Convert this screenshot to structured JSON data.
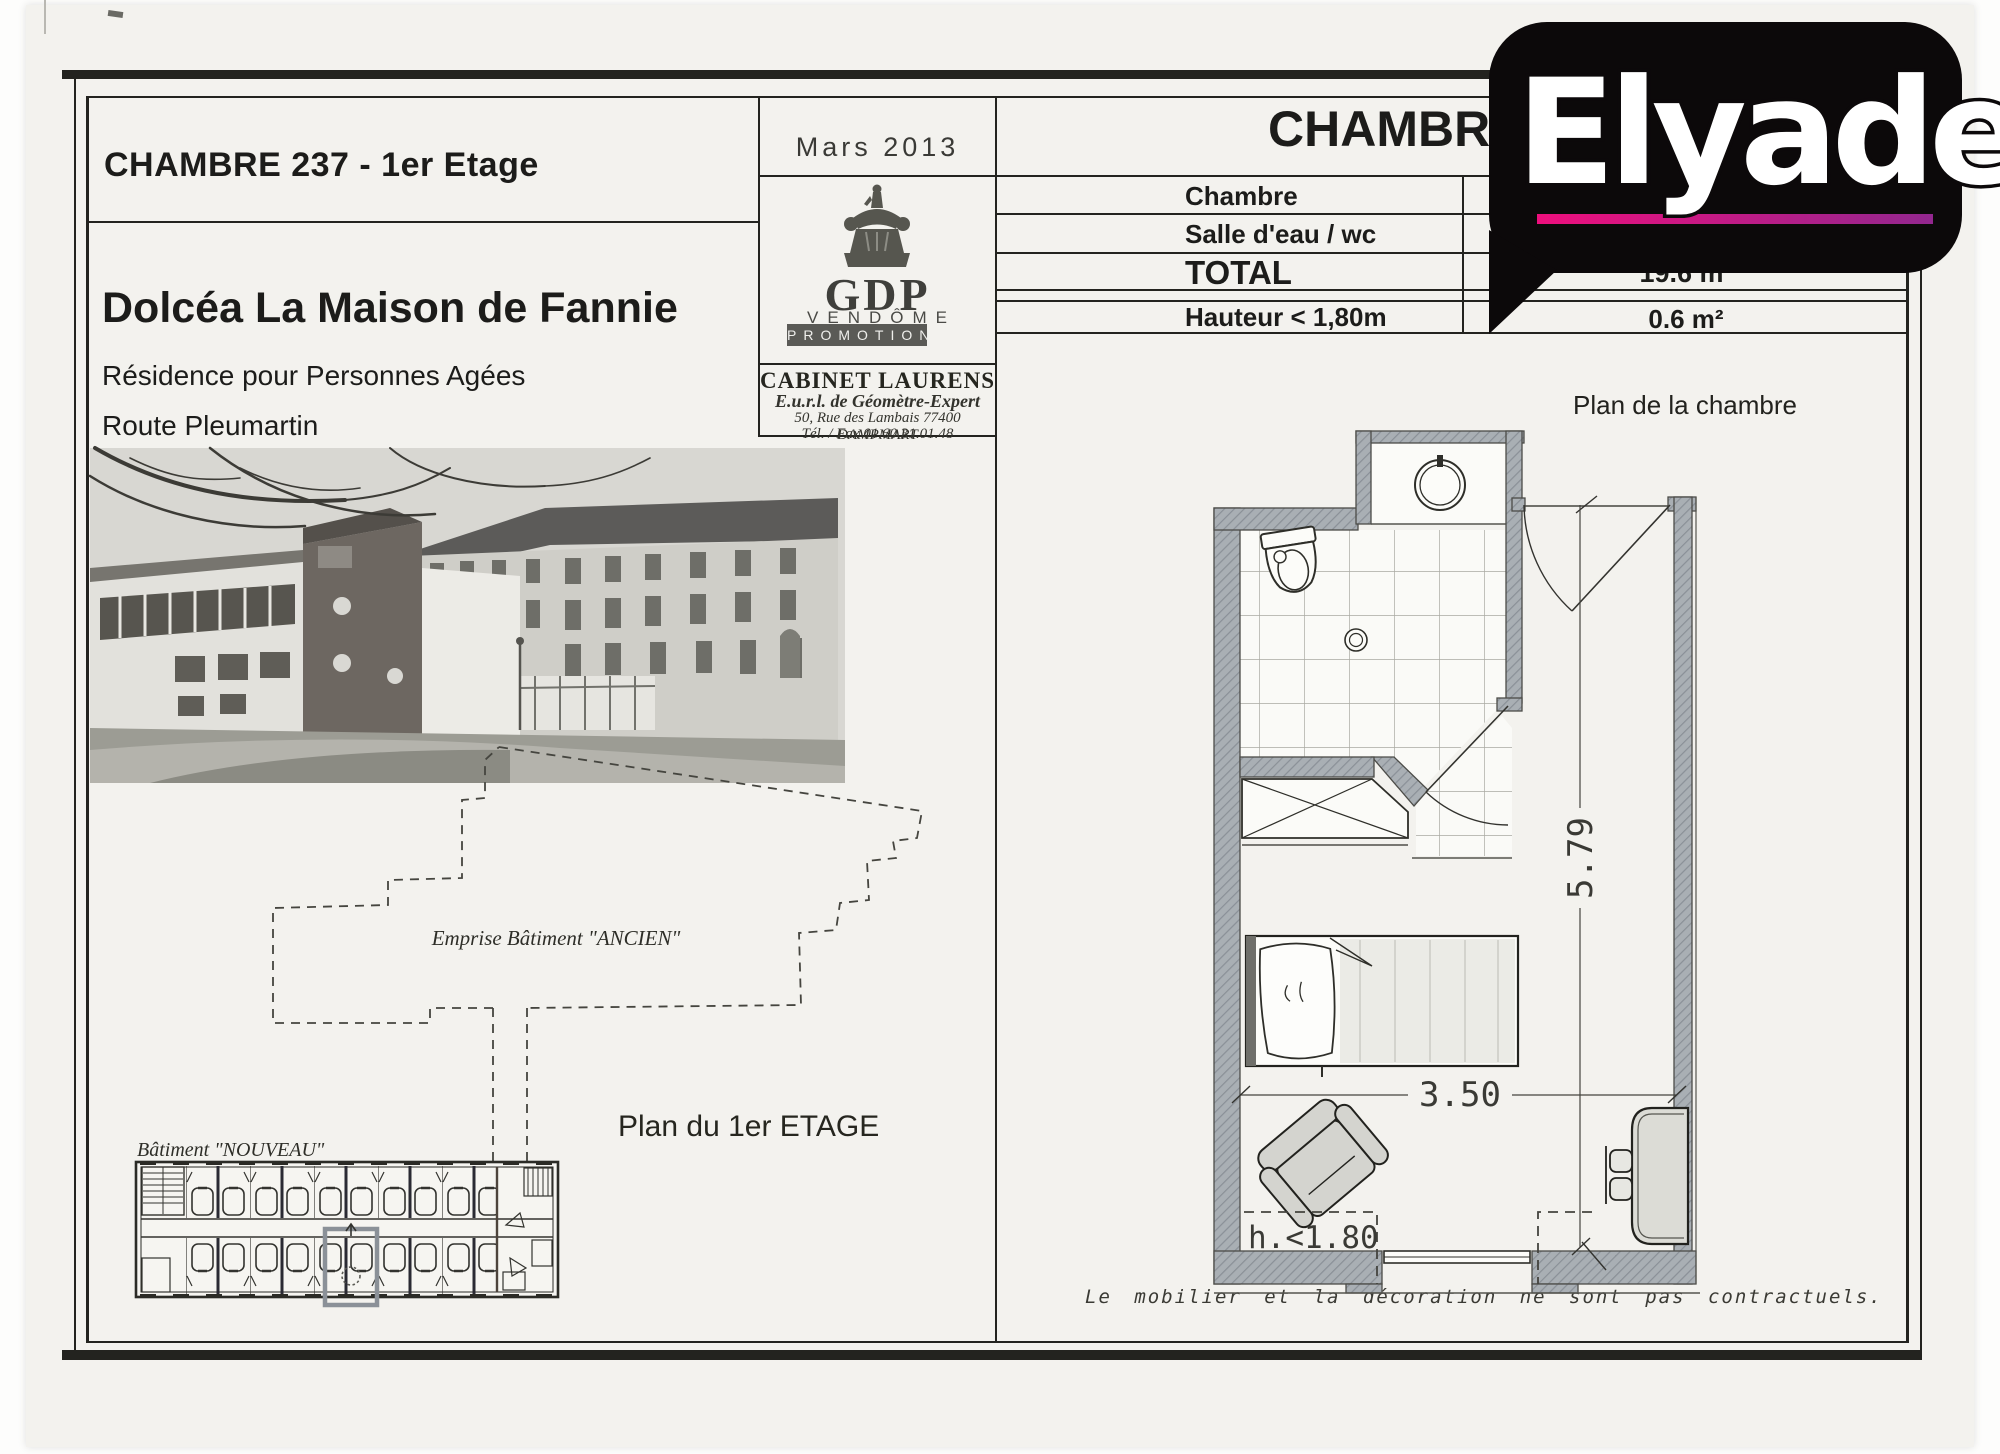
{
  "brand": {
    "name": "Elyade",
    "bubble_color": "#0c090a",
    "underline_start": "#ee0f7d",
    "underline_end": "#93278f"
  },
  "title_block": {
    "room_title": "CHAMBRE 237 - 1er Etage",
    "residence_name": "Dolcéa La Maison de Fannie",
    "residence_type": "Résidence pour Personnes Agées",
    "address_street": "Route Pleumartin",
    "address_city": "86100 CHATELLERAULT"
  },
  "date_block": {
    "date": "Mars 2013"
  },
  "promoter": {
    "acronym": "GDP",
    "name": "VENDÔME",
    "banner": "PROMOTION"
  },
  "surveyor": {
    "name": "CABINET LAURENS",
    "legal": "E.u.r.l. de Géomètre-Expert",
    "address": "50, Rue des Lambais 77400 DAMPMART",
    "phone": "Tél. / Fax 01.60.31.01.48"
  },
  "room_sheet": {
    "title": "CHAMBR",
    "plan_caption": "Plan de la chambre",
    "disclaimer": "Le mobilier et la décoration ne sont pas contractuels."
  },
  "surface_table": {
    "rows": [
      {
        "label": "Chambre",
        "value": ""
      },
      {
        "label": "Salle d'eau / wc",
        "value": ""
      },
      {
        "label": "TOTAL",
        "value": "19.6 m²"
      },
      {
        "label": "Hauteur < 1,80m",
        "value": "0.6 m²"
      }
    ]
  },
  "floor_plan": {
    "room_length": "5.79",
    "room_width": "3.50",
    "low_ceiling_zone": "h.<1.80"
  },
  "site_plans": {
    "old_building_label": "Emprise Bâtiment \"ANCIEN\"",
    "floor_label": "Plan du 1er ETAGE",
    "new_building_label": "Bâtiment \"NOUVEAU\""
  }
}
